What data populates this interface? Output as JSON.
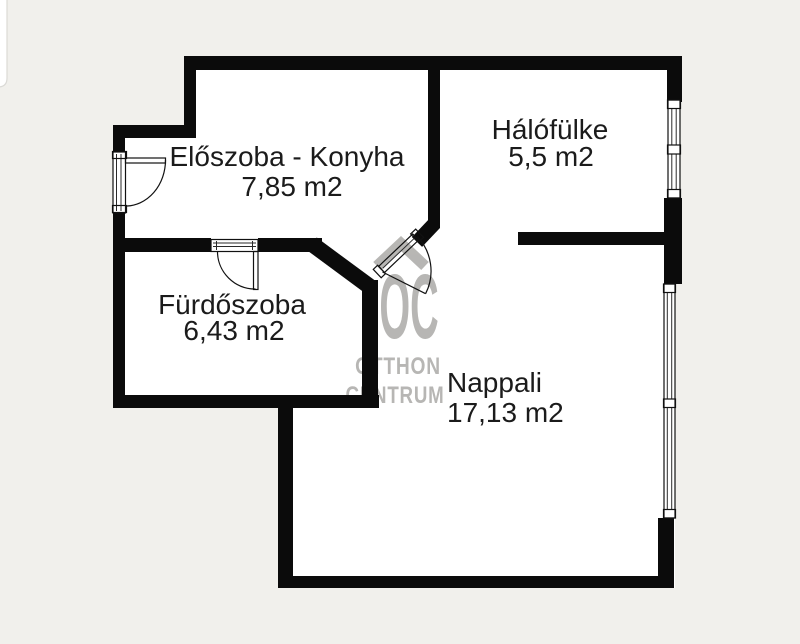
{
  "page": {
    "background_color": "#f1f0ec"
  },
  "floorplan": {
    "wall_color": "#0b0b0b",
    "room_fill_color": "#ffffff",
    "label_color": "#1b1b1b",
    "rooms": [
      {
        "name": "Előszoba - Konyha",
        "area": "7,85 m2"
      },
      {
        "name": "Hálófülke",
        "area": "5,5 m2"
      },
      {
        "name": "Fürdőszoba",
        "area": "6,43 m2"
      },
      {
        "name": "Nappali",
        "area": "17,13 m2"
      }
    ]
  },
  "watermark": {
    "monogram": "OC",
    "word1": "OTTHON",
    "word2": "CENTRUM",
    "color": "#b0afac",
    "icon": "house-roof-icon"
  }
}
